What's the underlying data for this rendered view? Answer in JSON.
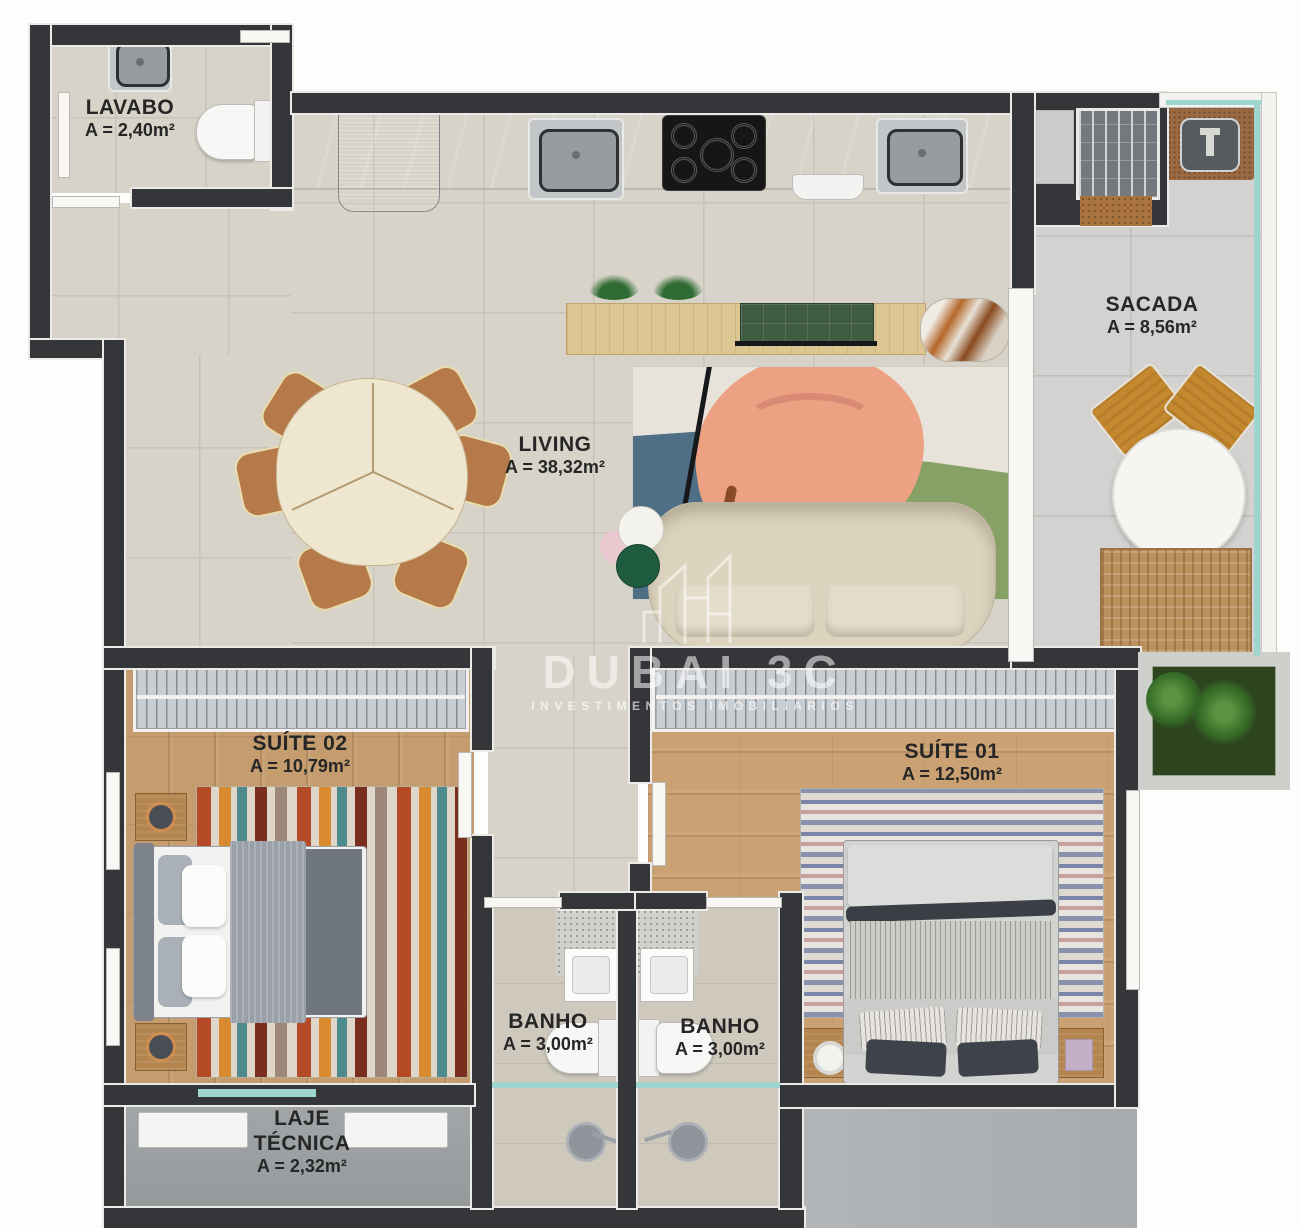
{
  "brand": {
    "name": "DUBAI 3C",
    "tagline": "INVESTIMENTOS IMOBILIARIOS"
  },
  "rooms": {
    "lavabo": {
      "name": "LAVABO",
      "area": "A = 2,40m²"
    },
    "living": {
      "name": "LIVING",
      "area": "A = 38,32m²"
    },
    "sacada": {
      "name": "SACADA",
      "area": "A = 8,56m²"
    },
    "suite02": {
      "name": "SUÍTE 02",
      "area": "A = 10,79m²"
    },
    "suite01": {
      "name": "SUÍTE 01",
      "area": "A = 12,50m²"
    },
    "banho1": {
      "name": "BANHO",
      "area": "A = 3,00m²"
    },
    "banho2": {
      "name": "BANHO",
      "area": "A = 3,00m²"
    },
    "laje": {
      "name": "LAJE TÉCNICA",
      "area": "A = 2,32m²"
    }
  },
  "colors": {
    "wall": "#34363a",
    "floor_tile": "#d7d3c8",
    "floor_wood": "#c49c6d",
    "counter_green": "#6f9f8b",
    "glass_accent": "#9ed6cf",
    "label_text": "#262626"
  }
}
